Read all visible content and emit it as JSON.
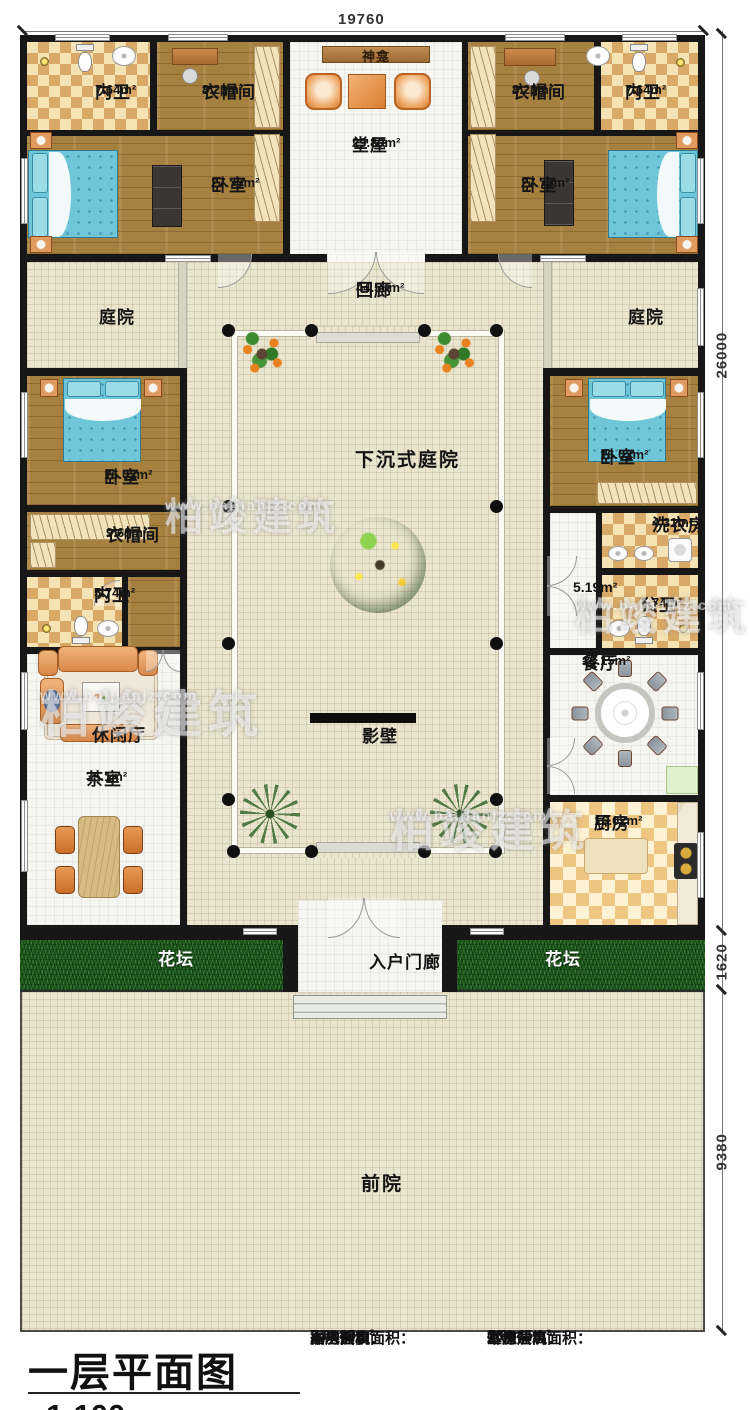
{
  "dimensions": {
    "top": "19760",
    "right_main": "26000",
    "right_bed": "1620",
    "right_yard": "9380"
  },
  "watermark": {
    "brand": "柏竣建筑",
    "url": "www.baijianjz.com"
  },
  "rooms": {
    "bath_tl": {
      "name": "内卫",
      "area": "7.64m²"
    },
    "cloak_tl": {
      "name": "衣帽间",
      "area": "8.23m²"
    },
    "bed_tl": {
      "name": "卧室",
      "area": "27.70m²"
    },
    "hall": {
      "name": "堂屋",
      "area": "29.80m²"
    },
    "shrine": {
      "name": "神龛"
    },
    "cloak_tr": {
      "name": "衣帽间",
      "area": "8.23m²"
    },
    "bath_tr": {
      "name": "内卫",
      "area": "7.64m²"
    },
    "bed_tr": {
      "name": "卧室",
      "area": "27.70m²"
    },
    "courtyard_left": {
      "name": "庭院"
    },
    "corridor": {
      "name": "回廊",
      "area": "44.56m²"
    },
    "courtyard_right": {
      "name": "庭院"
    },
    "bed_ml": {
      "name": "卧室",
      "area": "16.02m²"
    },
    "sunken": {
      "name": "下沉式庭院"
    },
    "bed_mr": {
      "name": "卧室",
      "area": "16.02m²"
    },
    "cloak_l": {
      "name": "衣帽间",
      "area": "9.68m²"
    },
    "laundry": {
      "name": "洗衣房",
      "area": "4.31m²"
    },
    "bath_l": {
      "name": "内卫",
      "area": "5.74m²"
    },
    "hallway": {
      "area": "5.19m²"
    },
    "bath_pub": {
      "name": "公卫",
      "area": "5.74m²"
    },
    "dining": {
      "name": "餐厅",
      "area": "18.15m²"
    },
    "lounge": {
      "name": "休闲厅"
    },
    "screen": {
      "name": "影壁"
    },
    "tea": {
      "name": "茶室",
      "area": "35.1m²"
    },
    "kitchen": {
      "name": "厨房",
      "area": "16.02m²"
    },
    "flowerbed_l": {
      "name": "花坛"
    },
    "porch": {
      "name": "入户门廊"
    },
    "flowerbed_r": {
      "name": "花坛"
    },
    "front_yard": {
      "name": "前院"
    }
  },
  "title_block": {
    "title": "一层平面图",
    "scale": "1:100",
    "col1": [
      {
        "label": "本层建筑面积：",
        "value": "334.45m²"
      },
      {
        "label": "占地面积：",
        "value": "744.80m²"
      },
      {
        "label": "厢房层高：",
        "value": "3.6m"
      }
    ],
    "col2": [
      {
        "label": "本栋建筑面积：",
        "value": "334.45m²"
      },
      {
        "label": "耳房层高：",
        "value": "3.6m"
      },
      {
        "label": "堂屋层高：",
        "value": "4.2m"
      }
    ]
  }
}
